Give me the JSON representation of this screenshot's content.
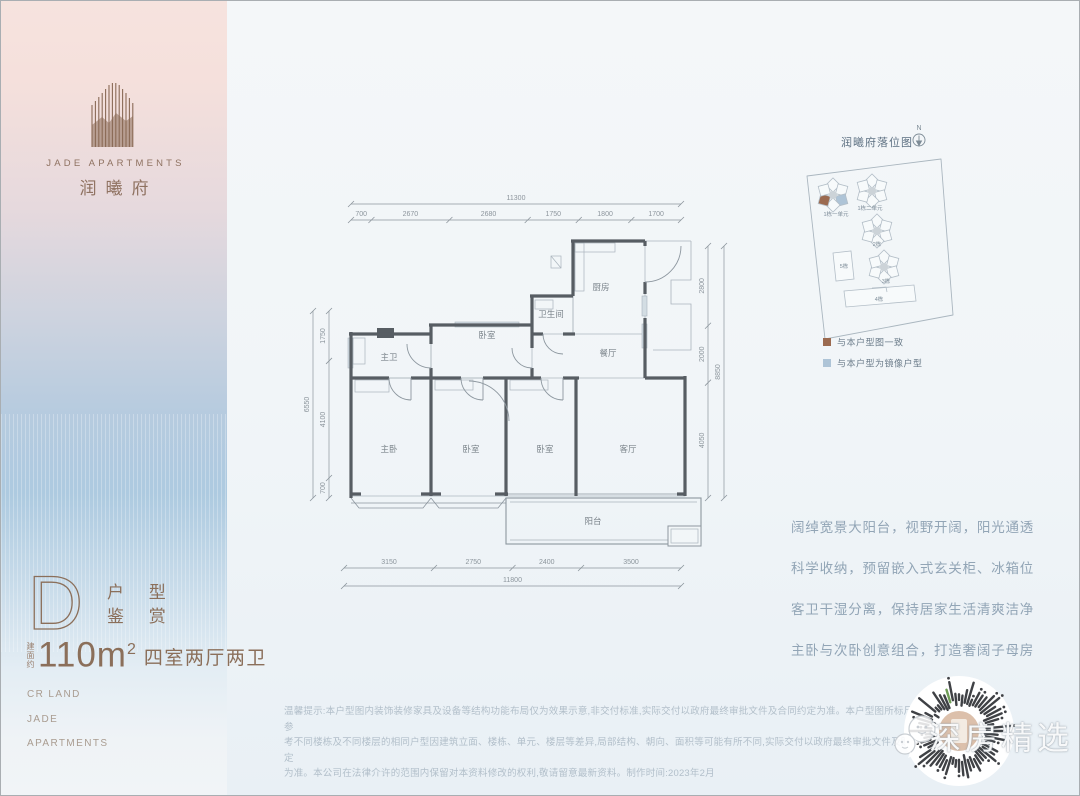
{
  "brand": {
    "logo_en": "JADE APARTMENTS",
    "logo_cn": "润曦府"
  },
  "unit_card": {
    "letter": "D",
    "subtitle_line1": "户 型",
    "subtitle_line2": "鉴 赏",
    "area_prefix": "建面约",
    "area_number": "110m",
    "area_sup": "2",
    "rooms_desc": "四室两厅两卫",
    "footer_lines": [
      "CR LAND",
      "JADE",
      "APARTMENTS"
    ]
  },
  "floorplan": {
    "room_labels": [
      {
        "t": "厨房",
        "x": 312,
        "y": 106
      },
      {
        "t": "卫生间",
        "x": 262,
        "y": 133
      },
      {
        "t": "餐厅",
        "x": 319,
        "y": 172
      },
      {
        "t": "卧室",
        "x": 198,
        "y": 154
      },
      {
        "t": "主卫",
        "x": 100,
        "y": 176
      },
      {
        "t": "主卧",
        "x": 100,
        "y": 268
      },
      {
        "t": "卧室",
        "x": 182,
        "y": 268
      },
      {
        "t": "卧室",
        "x": 256,
        "y": 268
      },
      {
        "t": "客厅",
        "x": 339,
        "y": 268
      },
      {
        "t": "阳台",
        "x": 304,
        "y": 340
      }
    ],
    "dim_top": {
      "total": "11300",
      "segments": [
        700,
        2670,
        2680,
        1750,
        1800,
        1700
      ]
    },
    "dim_bottom": {
      "total": "11800",
      "segments": [
        3150,
        2750,
        2400,
        3500
      ]
    },
    "dim_left": {
      "total": "6550",
      "segments": [
        1750,
        4100,
        700
      ]
    },
    "dim_right": {
      "total": "8850",
      "segments": [
        2800,
        2000,
        4050
      ]
    }
  },
  "siteplan": {
    "title": "润曦府落位图",
    "north_label": "N",
    "clusters": [
      {
        "type": "pinwheel",
        "x": 42,
        "y": 76,
        "label": "1栋一单元",
        "lx": 45,
        "ly": 97,
        "highlight": true
      },
      {
        "type": "pinwheel",
        "x": 81,
        "y": 72,
        "label": "1栋二单元",
        "lx": 79,
        "ly": 91
      },
      {
        "type": "pinwheel",
        "x": 86,
        "y": 112,
        "label": "2栋",
        "lx": 86,
        "ly": 127
      },
      {
        "type": "pinwheel",
        "x": 93,
        "y": 148,
        "label": "3栋",
        "lx": 95,
        "ly": 164
      },
      {
        "type": "slab-v",
        "x": 42,
        "y": 134,
        "label": "5栋",
        "lx": 53,
        "ly": 149
      },
      {
        "type": "slab-h",
        "x": 53,
        "y": 172,
        "label": "4栋",
        "lx": 88,
        "ly": 182
      }
    ],
    "legend": [
      {
        "color": "#9b6a50",
        "label": "与本户型图一致"
      },
      {
        "color": "#aec4d7",
        "label": "与本户型为镜像户型"
      }
    ],
    "highlight_brown": "#9b6a50",
    "highlight_blue": "#aec4d7"
  },
  "features": [
    "阔绰宽景大阳台，视野开阔，阳光通透",
    "科学收纳，预留嵌入式玄关柜、冰箱位",
    "客卫干湿分离，保持居家生活清爽洁净",
    "主卧与次卧创意组合，打造奢阔子母房"
  ],
  "disclaimer_lines": [
    "温馨提示:本户型图内装饰装修家具及设备等结构功能布局仅为效果示意,非交付标准,实际交付以政府最终审批文件及合同约定为准。本户型图所标尺寸仅供参",
    "考不同楼栋及不同楼层的相同户型因建筑立面、楼栋、单元、楼层等差异,局部结构、朝向、面积等可能有所不同,实际交付以政府最终审批文件及购房合同约定",
    "为准。本公司在法律介许的范围内保留对本资料修改的权利,敬请留意最新资料。制作时间:2023年2月"
  ],
  "watermark": {
    "text": "深房精选"
  }
}
